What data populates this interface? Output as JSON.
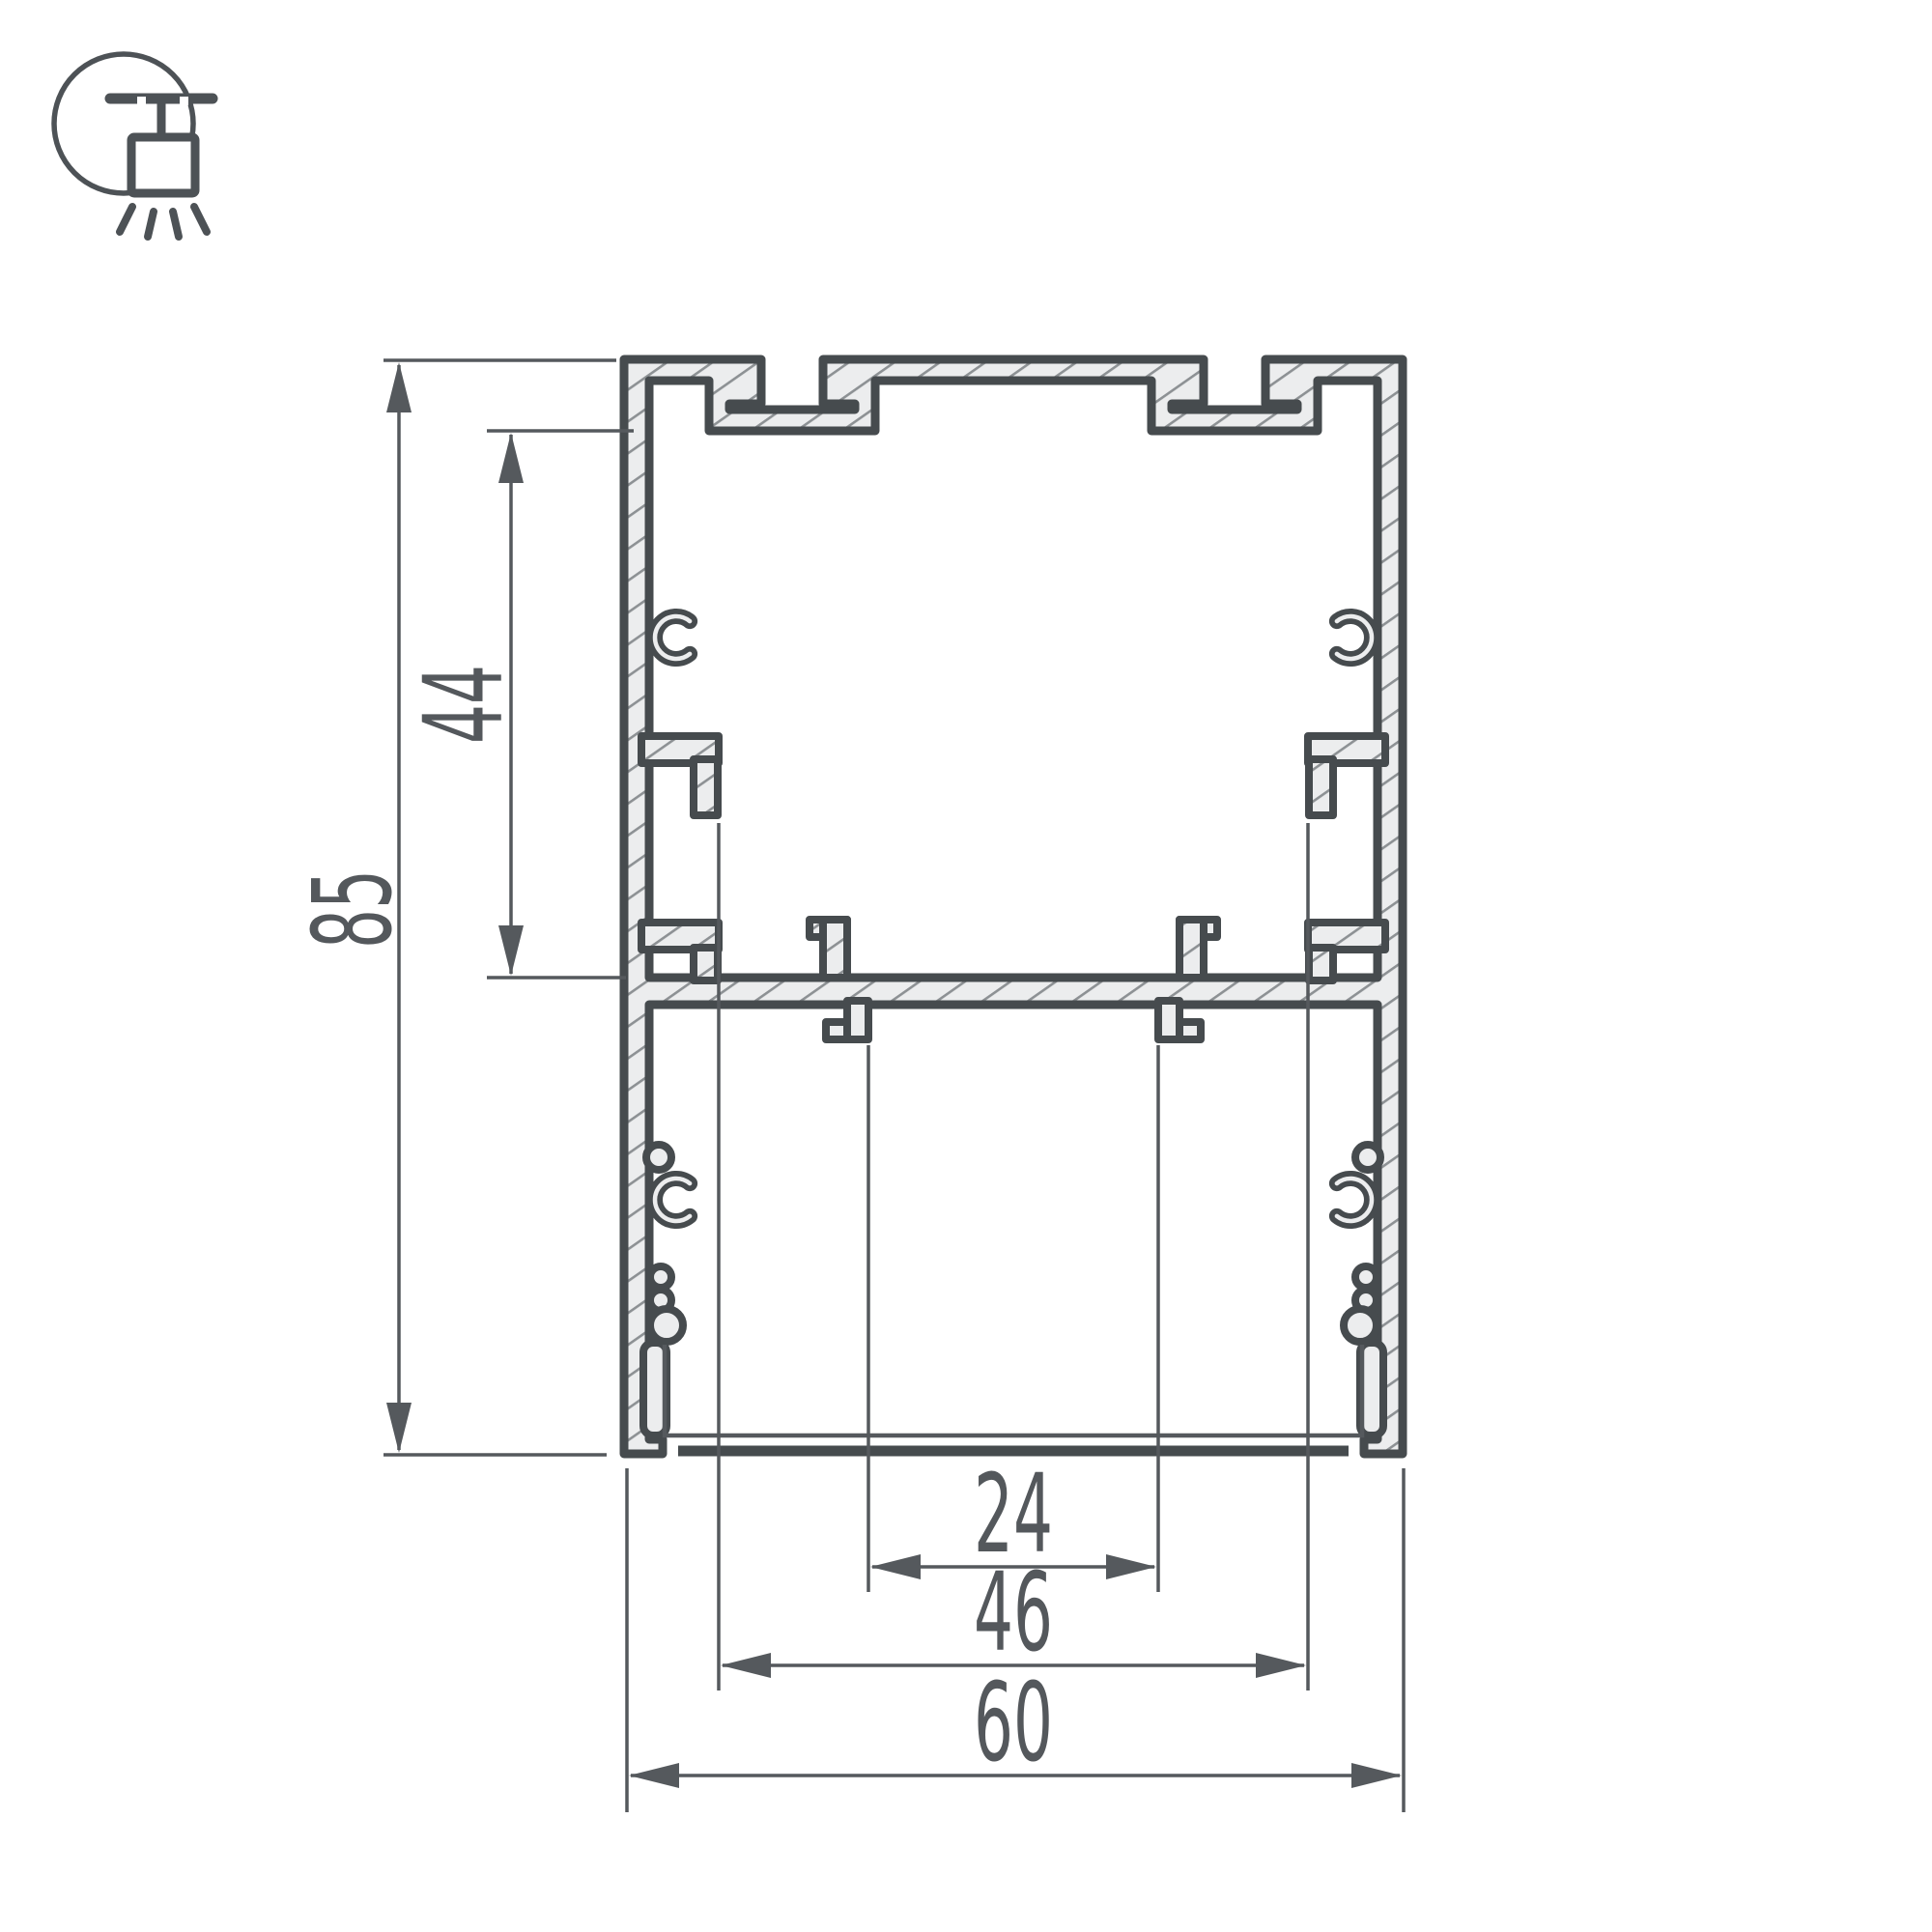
{
  "drawing": {
    "title": "aluminum-led-profile-cross-section",
    "icon": "pendant-ceiling-light",
    "dimensions": {
      "overall_height": "85",
      "upper_cavity_depth": "44",
      "led_shelf_width": "24",
      "inner_width": "46",
      "overall_width": "60"
    },
    "colors": {
      "outline": "#464b4e",
      "dimension_lines": "#55595d",
      "text": "#54585c",
      "material_fill": "#ecedee",
      "hatch_lines": "#8d9194",
      "background": "#ffffff"
    }
  }
}
